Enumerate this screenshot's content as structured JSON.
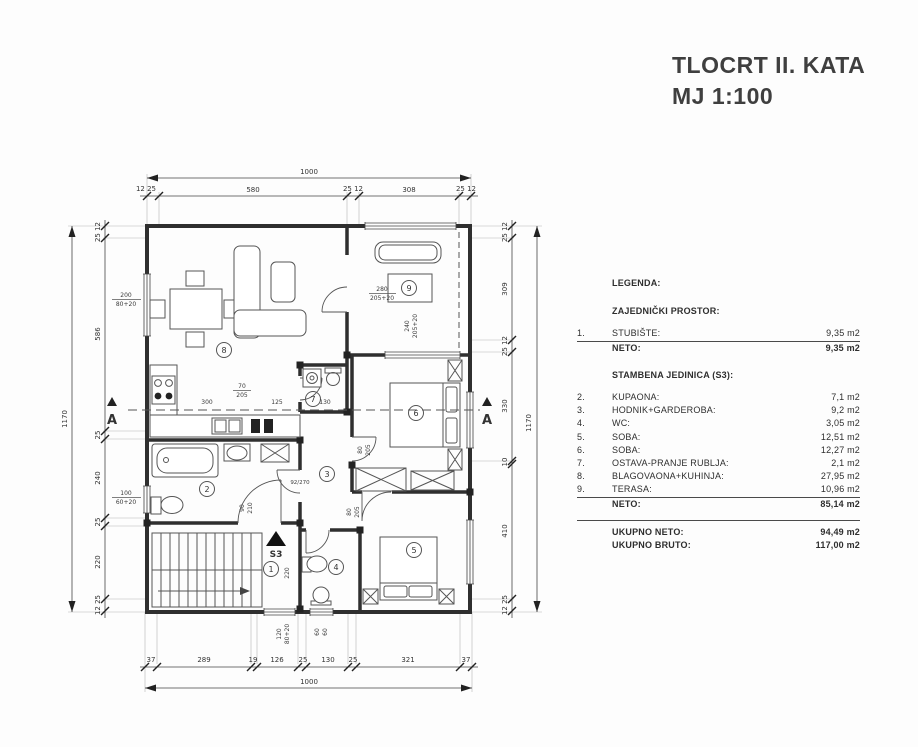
{
  "title": {
    "line1": "TLOCRT II. KATA",
    "line2": "MJ 1:100"
  },
  "legend": {
    "heading": "LEGENDA:",
    "common_title": "ZAJEDNIČKI PROSTOR:",
    "common_rows": [
      {
        "num": "1.",
        "label": "STUBIŠTE:",
        "value": "9,35 m2"
      }
    ],
    "common_total": {
      "num": "",
      "label": "NETO:",
      "value": "9,35 m2"
    },
    "unit_title": "STAMBENA JEDINICA (S3):",
    "unit_rows": [
      {
        "num": "2.",
        "label": "KUPAONA:",
        "value": "7,1 m2"
      },
      {
        "num": "3.",
        "label": "HODNIK+GARDEROBA:",
        "value": "9,2 m2"
      },
      {
        "num": "4.",
        "label": "WC:",
        "value": "3,05 m2"
      },
      {
        "num": "5.",
        "label": "SOBA:",
        "value": "12,51 m2"
      },
      {
        "num": "6.",
        "label": "SOBA:",
        "value": "12,27 m2"
      },
      {
        "num": "7.",
        "label": "OSTAVA-PRANJE RUBLJA:",
        "value": "2,1 m2"
      },
      {
        "num": "8.",
        "label": "BLAGOVAONA+KUHINJA:",
        "value": "27,95 m2"
      },
      {
        "num": "9.",
        "label": "TERASA:",
        "value": "10,96 m2"
      }
    ],
    "unit_total": {
      "num": "",
      "label": "NETO:",
      "value": "85,14 m2"
    },
    "totals": [
      {
        "label": "UKUPNO NETO:",
        "value": "94,49 m2"
      },
      {
        "label": "UKUPNO BRUTO:",
        "value": "117,00 m2"
      }
    ]
  },
  "dims": {
    "top": {
      "overall": "1000",
      "segs": [
        "12 25",
        "580",
        "25 12",
        "308",
        "25 12"
      ]
    },
    "bottom": {
      "overall": "1000",
      "segs": [
        "37",
        "289",
        "19",
        "126",
        "25",
        "130",
        "25",
        "321",
        "37"
      ]
    },
    "left": {
      "overall": "1170",
      "segs": [
        "25 12",
        "586",
        "25",
        "240",
        "25",
        "220",
        "12 25"
      ]
    },
    "right": {
      "overall": "1170",
      "segs": [
        "25 12",
        "309",
        "25 12",
        "330",
        "10",
        "410",
        "12 25"
      ]
    }
  },
  "plan": {
    "rooms": {
      "r1": "1",
      "r2": "2",
      "r3": "3",
      "r4": "4",
      "r5": "5",
      "r6": "6",
      "r7": "7",
      "r8": "8",
      "r9": "9"
    },
    "stair_mark": "S3",
    "section_mark": "A",
    "openings": {
      "w200": [
        "200",
        "80+20"
      ],
      "w100": [
        "100",
        "60+20"
      ],
      "w280": [
        "280",
        "205+20"
      ],
      "w240": [
        "240",
        "205+20"
      ],
      "w120": [
        "120",
        "80+20"
      ],
      "w60": [
        "60",
        "60"
      ],
      "d70": [
        "70",
        "205"
      ],
      "d80a": [
        "80",
        "205"
      ],
      "d80b": [
        "80",
        "205"
      ],
      "d90": [
        "90",
        "210"
      ]
    },
    "inner_dims": {
      "k300": "300",
      "k125": "125",
      "k130": "130",
      "k220": "220",
      "k92": "92/270"
    }
  }
}
